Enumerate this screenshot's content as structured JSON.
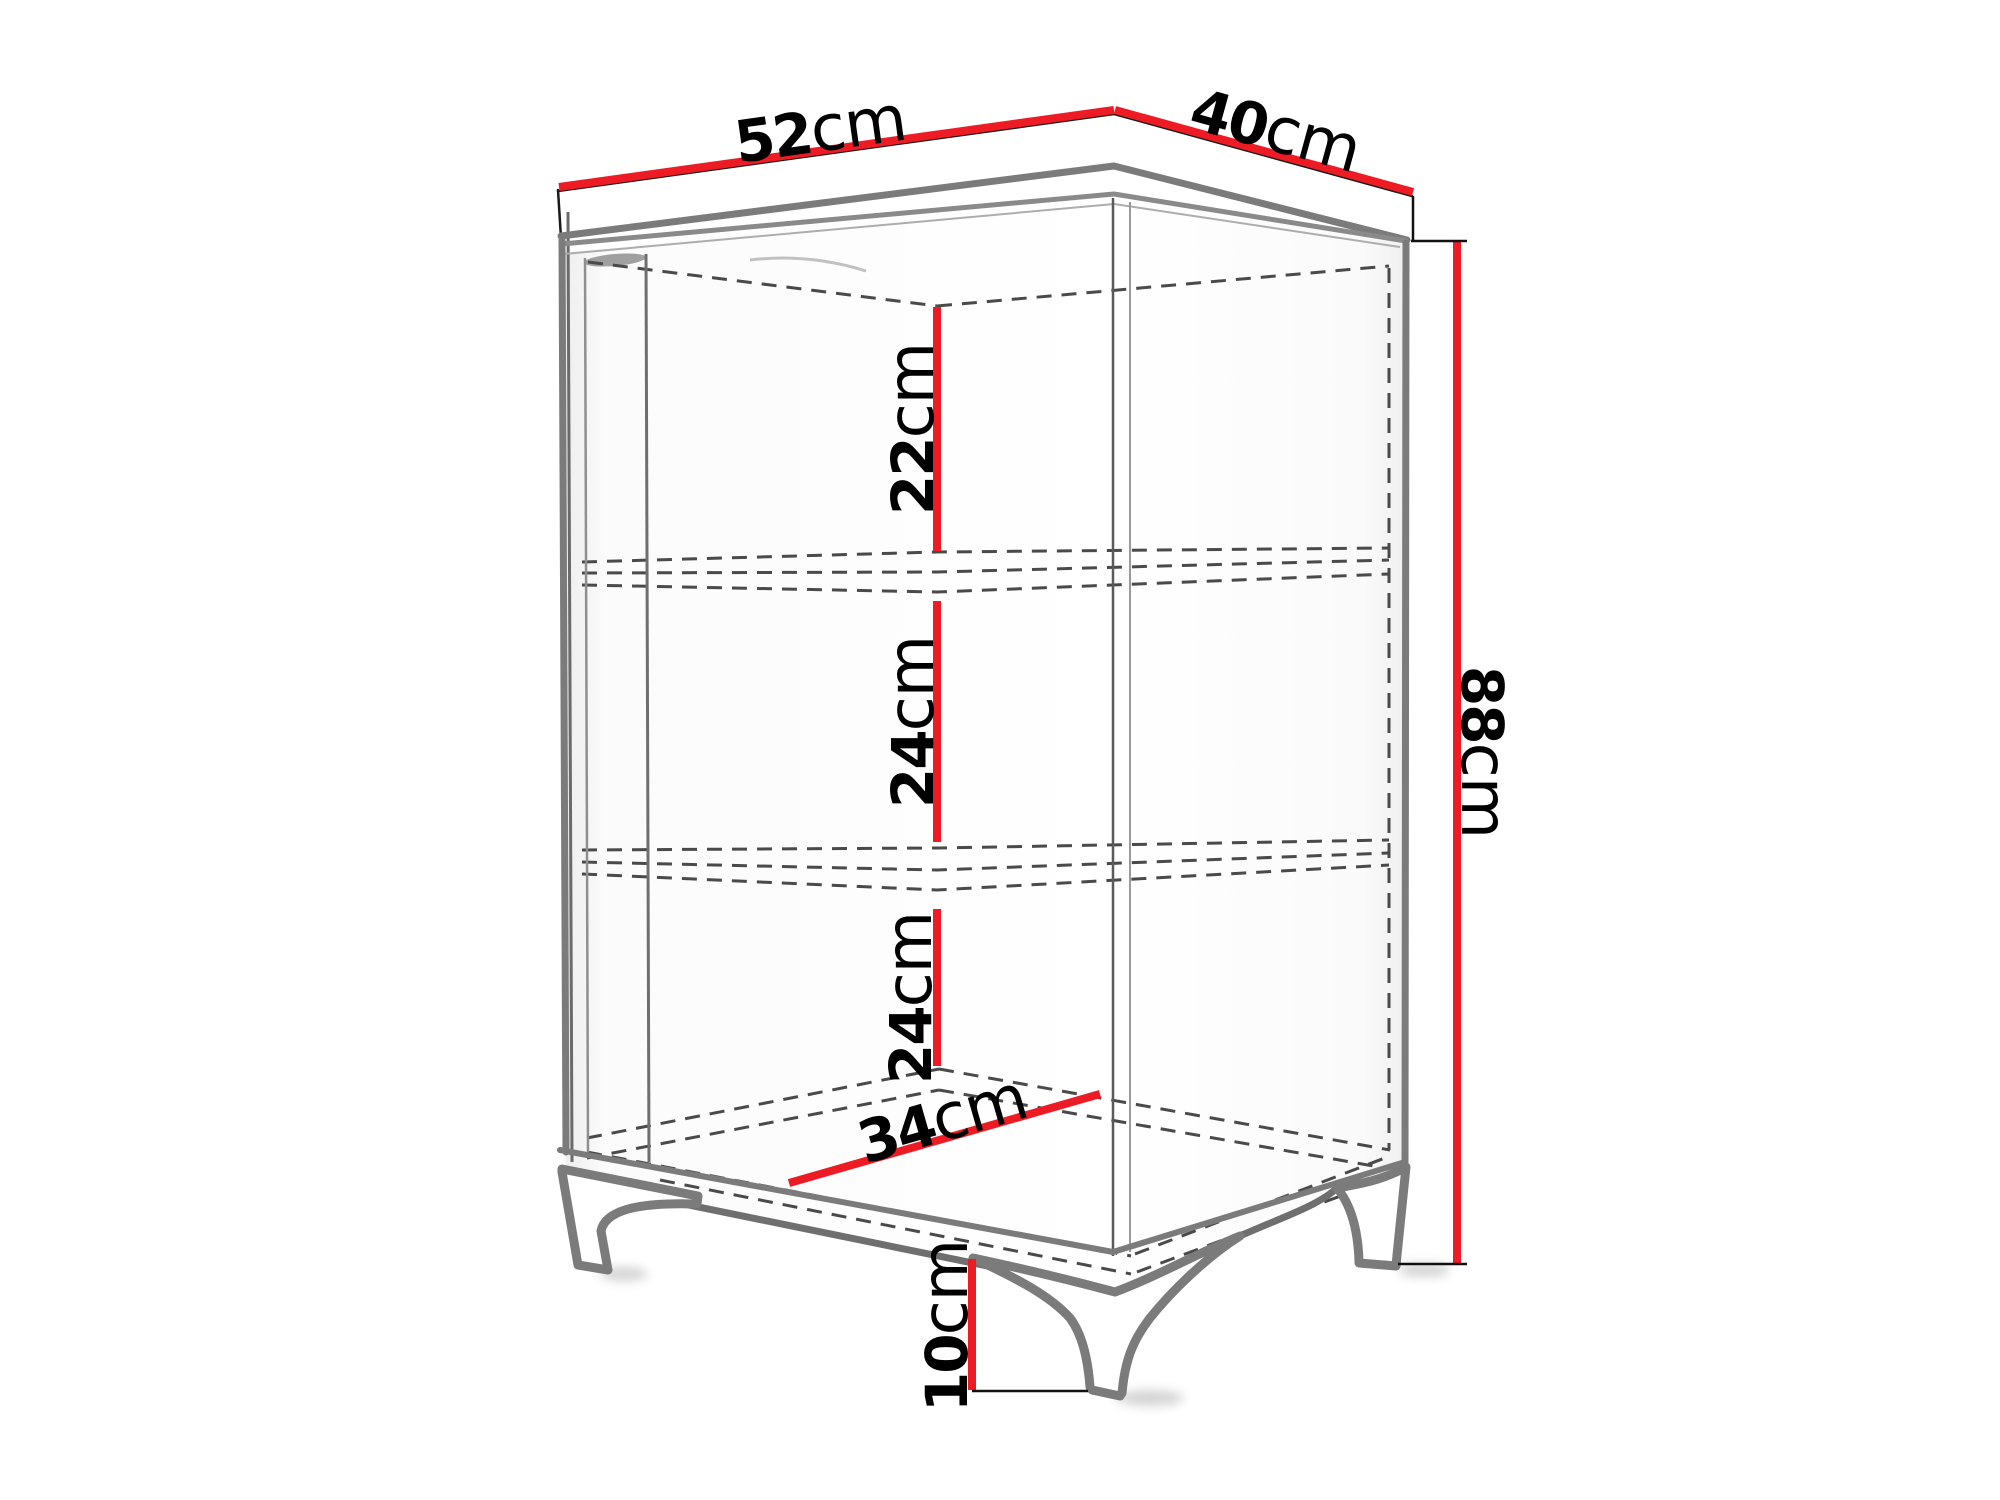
{
  "diagram": {
    "title": "Corner cabinet dimension diagram",
    "unit": "cm",
    "colors": {
      "dimension_line": "#ed1c24",
      "outline_gray": "#7b7b7b",
      "hidden_line": "#4a4a4a",
      "label_text": "#000000",
      "background": "#ffffff"
    },
    "dimensions": {
      "top_left_width": {
        "value": "52",
        "unit": "cm"
      },
      "top_right_depth": {
        "value": "40",
        "unit": "cm"
      },
      "overall_height": {
        "value": "88",
        "unit": "cm"
      },
      "top_compartment_height": {
        "value": "22",
        "unit": "cm"
      },
      "middle_compartment_height": {
        "value": "24",
        "unit": "cm"
      },
      "bottom_compartment_height": {
        "value": "24",
        "unit": "cm"
      },
      "interior_bottom_width": {
        "value": "34",
        "unit": "cm"
      },
      "leg_height": {
        "value": "10",
        "unit": "cm"
      }
    }
  }
}
